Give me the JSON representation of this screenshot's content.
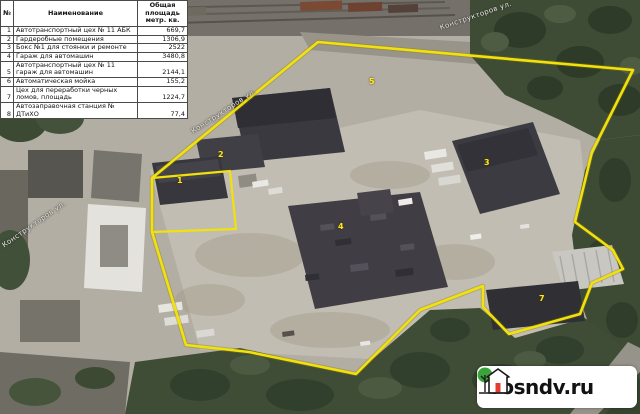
{
  "table": {
    "headers": {
      "num": "№",
      "name": "Наименование",
      "area_line1": "Общая площадь",
      "area_line2": "метр. кв."
    },
    "rows": [
      {
        "num": "1",
        "name": "Автотранспортный цех № 11 АБК",
        "area": "669,7"
      },
      {
        "num": "2",
        "name": "Гардеробные помещения",
        "area": "1306,9"
      },
      {
        "num": "3",
        "name": "Бокс №1 для стоянки и ремонте",
        "area": "2522"
      },
      {
        "num": "4",
        "name": "Гараж для автомашин",
        "area": "3480,8"
      },
      {
        "num": "5",
        "name": "Автотранспортный цех № 11 гараж для автомашин",
        "area": "2144,1"
      },
      {
        "num": "6",
        "name": "Автоматическая мойка",
        "area": "155,2"
      },
      {
        "num": "7",
        "name": "Цех для переработки черных ломов, площадь",
        "area": "1224,7"
      },
      {
        "num": "8",
        "name": "Автозаправочная станция № ДТиХО",
        "area": "77,4"
      }
    ]
  },
  "map": {
    "street_labels": [
      {
        "text": "Конструкторов ул."
      },
      {
        "text": "Конструкторов ул."
      },
      {
        "text": "Конструкторов ул."
      }
    ],
    "markers": [
      {
        "label": "1"
      },
      {
        "label": "2"
      },
      {
        "label": "5"
      },
      {
        "label": "3"
      },
      {
        "label": "4"
      },
      {
        "label": "7"
      }
    ],
    "boundary_color": "#f2e10c"
  },
  "watermark": {
    "site": "rosndv.ru",
    "logo_tree_color": "#3aa43a",
    "logo_door_color": "#e03c31"
  }
}
